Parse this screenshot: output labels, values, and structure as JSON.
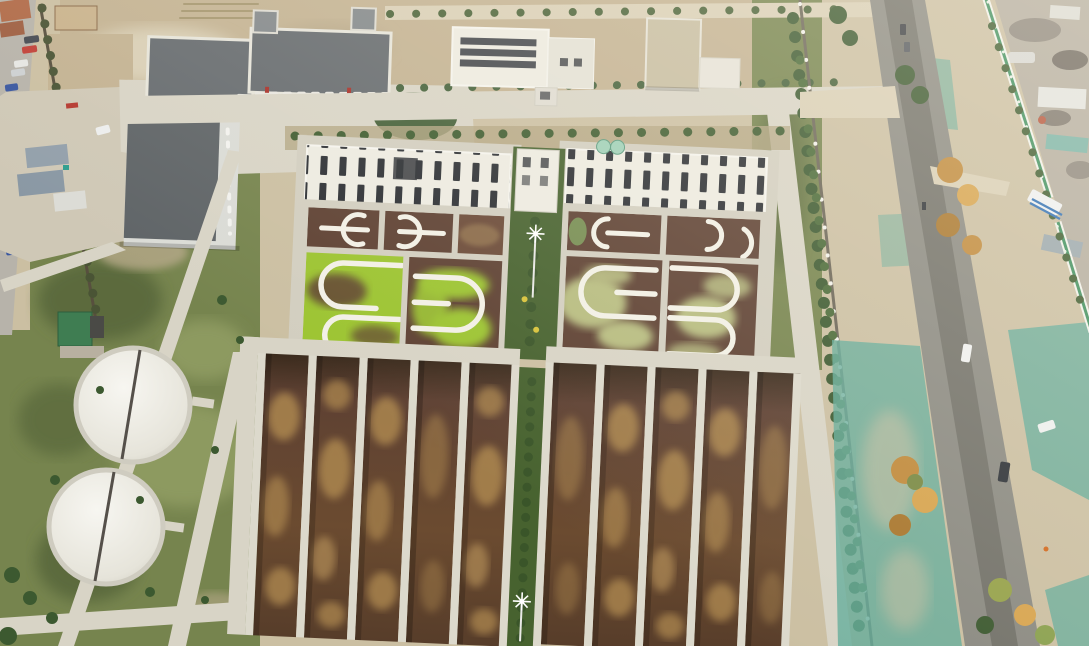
{
  "scene": {
    "type": "aerial-drone-photo",
    "title": "Aerial view of a wastewater treatment plant beside a rural road",
    "labels": {
      "plant": "wastewater-treatment-plant",
      "admin_buildings": "office-and-plant-buildings",
      "clarifiers": "covered-circular-tanks",
      "ditch_complex_left": "oxidation-ditch-complex-green-algae",
      "ditch_complex_right": "oxidation-ditch-complex-pale-algae",
      "aeration_lanes": "long-aeration-basin-lanes",
      "road": "rural-asphalt-road",
      "netting": "teal-dust-control-netting",
      "fence": "green-white-boundary-fence",
      "scrapyard": "industrial-yard-with-sheds",
      "street": "side-street-with-parked-cars",
      "light_poles": "high-mast-light-poles"
    },
    "counts": {
      "circular_tanks": 2,
      "ditch_complexes": 2,
      "aeration_lanes": 10,
      "road_vehicles": 3,
      "parked_cars": 6,
      "high_mast_lights": 2
    }
  },
  "palette": {
    "dust": "#cbbfa2",
    "dustLight": "#d9cfb6",
    "dirt": "#c3b292",
    "concrete": "#d8d4c6",
    "concreteBright": "#ebe9e0",
    "asphalt": "#8b8a82",
    "asphaltDark": "#6d6c64",
    "grass": "#76844e",
    "grassLight": "#8d9a60",
    "grassDark": "#5c6b3e",
    "veg": "#47622f",
    "tree": "#3c5930",
    "algae": "#9cc431",
    "algaePale": "#b7bc80",
    "water": "#5e4133",
    "waterLight": "#7a5a3d",
    "mud": "#a8834e",
    "mudDark": "#3b2b1d",
    "wallWhite": "#edebe1",
    "frame": "#d2cec0",
    "slot": "#2c2f34",
    "roofDark": "#666b6f",
    "roofMid": "#83888b",
    "teal": "#63ab9a",
    "fence": "#3e8f5e",
    "autumn": "#c08a3c",
    "autumnLight": "#d7a44f",
    "rust": "#a9772e",
    "yard": "#b4ad9f"
  }
}
